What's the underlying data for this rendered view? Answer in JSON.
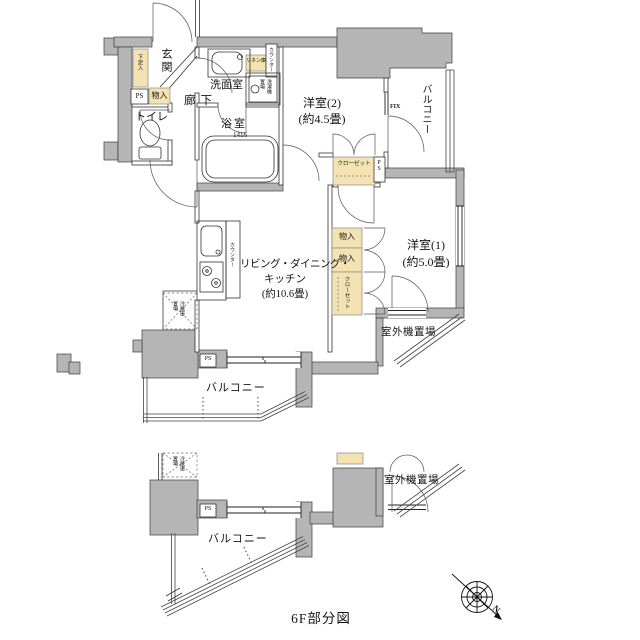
{
  "document": {
    "type": "floor-plan",
    "caption": "6F部分図"
  },
  "colors": {
    "wall": "#b5b5b5",
    "storage_box": "#f3e3b3",
    "line": "#333333",
    "background": "#ffffff"
  },
  "labels": {
    "genkan": "玄関",
    "shoe_cupboard": "下足入",
    "ps_entrance": "PS",
    "storage_entrance": "物入",
    "toilet": "トイレ",
    "hallway": "廊下",
    "washroom": "洗面室",
    "linen": "リネン庫",
    "counter_washroom": "カウンター",
    "laundry": "洗濯機置場",
    "bathroom": "浴室",
    "bathroom_size": "1416",
    "bedroom2_name": "洋室(2)",
    "bedroom2_area": "(約4.5畳)",
    "fix_window": "FIX",
    "balcony_east": "バルコニー",
    "closet_bedroom2": "クローゼット",
    "ps_east": "PS",
    "bedroom1_name": "洋室(1)",
    "bedroom1_area": "(約5.0畳)",
    "storage_mid_1": "物入",
    "storage_mid_2": "物入",
    "closet_bedroom1": "クローゼット",
    "ldk_line1": "リビング・ダイニング・",
    "ldk_line2": "キッチン",
    "ldk_line3": "(約10.6畳)",
    "counter_kitchen": "カウンター",
    "fridge": "冷蔵庫置場",
    "ps_south": "PS",
    "balcony_south": "バルコニー",
    "outdoor_unit": "室外機置場",
    "fridge_6f": "冷蔵庫置場",
    "ps_6f": "PS",
    "balcony_6f": "バルコニー",
    "outdoor_unit_6f": "室外機置場",
    "caption": "6F部分図",
    "compass_n": "N"
  }
}
